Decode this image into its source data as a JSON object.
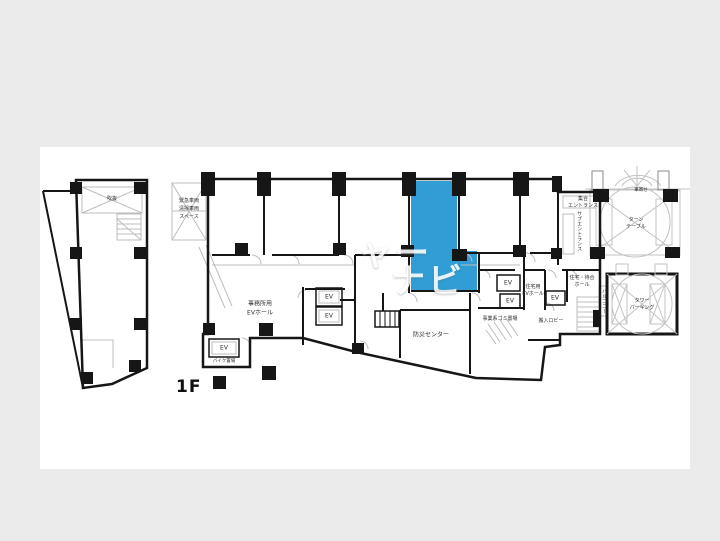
{
  "floor_label": "1F",
  "watermark": {
    "part1": "ャー",
    "part2": "ナビ",
    "color": "#ffffff"
  },
  "colors": {
    "background": "#ebebeb",
    "canvas": "#ffffff",
    "walls": "#161616",
    "highlight_room": "#309dd5",
    "light_detail": "#bdbdbd",
    "watermark": "#ffffff"
  },
  "labels": {
    "annex_void": "吹抜",
    "emergency_space": {
      "line1": "緊急車両",
      "line2": "清掃車両",
      "line3": "スペース"
    },
    "office_ev_hall": {
      "line1": "事務所用",
      "line2": "EVホール"
    },
    "ev": "EV",
    "bike_parking": "バイク置場",
    "disaster_center": "防災センター",
    "business_garbage": "事業系ゴミ置場",
    "loading_lobby": "搬入ロビー",
    "residential_ev_hall": {
      "line1": "住宅用",
      "line2": "EVホール"
    },
    "residence_waiting_hall": {
      "line1": "住宅・待合",
      "line2": "ホール"
    },
    "main_entrance": {
      "line1": "集合",
      "line2": "エントランス"
    },
    "sub_entrance": "サブエントランス",
    "turntable": {
      "line1": "ターン",
      "line2": "テーブル"
    },
    "porch": "車寄せ",
    "tower_parking": {
      "line1": "タワー",
      "line2": "パーキング"
    },
    "balcony": "バルコニー"
  }
}
